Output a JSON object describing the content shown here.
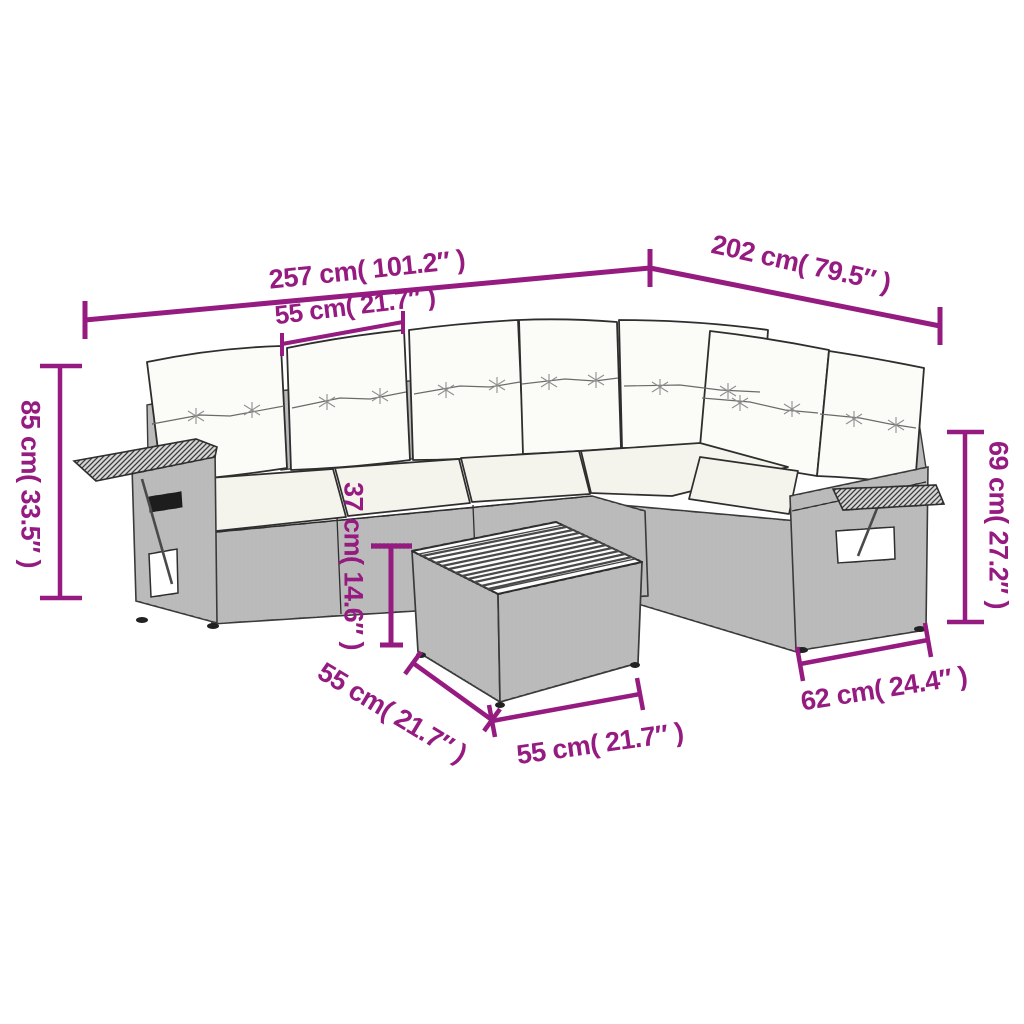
{
  "diagram": {
    "accent_color": "#951b81",
    "dimensions": {
      "total_width": "257 cm( 101.2″ )",
      "wing_depth": "202 cm( 79.5″ )",
      "seat_module_width": "55 cm( 21.7″ )",
      "overall_height": "85 cm( 33.5″ )",
      "backrest_height": "69 cm( 27.2″ )",
      "seat_height": "37 cm( 14.6″ )",
      "table_left_side": "55 cm( 21.7″ )",
      "table_front_side": "55 cm( 21.7″ )",
      "armrest_depth": "62 cm( 24.4″ )"
    }
  }
}
